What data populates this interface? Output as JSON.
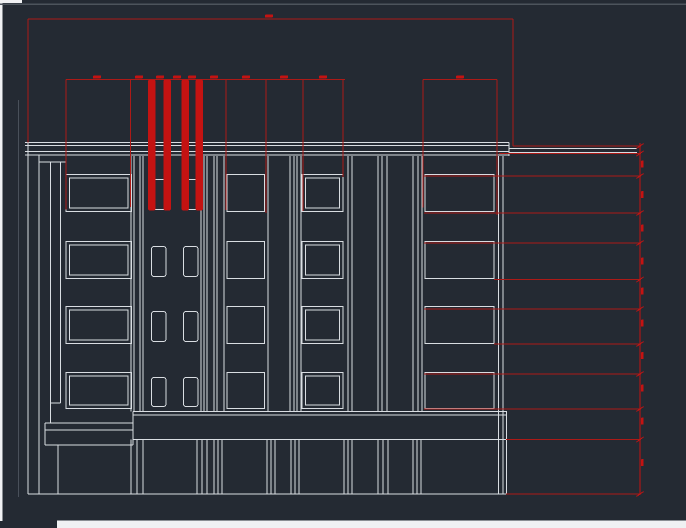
{
  "meta": {
    "description": "CAD viewport: building front elevation drawing with red dimension lines",
    "canvas_width": 686,
    "canvas_height": 528
  },
  "colors": {
    "background": "#242a33",
    "line_white": "#d9dde2",
    "line_bright": "#eef0f3",
    "line_gray": "#49505a",
    "dim_red": "#ac1a17",
    "dim_red_bright": "#c41312",
    "chrome_light": "#f0f1f3",
    "chrome_gray": "#4d545c"
  },
  "drawing": {
    "white_lines": [
      [
        25,
        142.5,
        509,
        142.5
      ],
      [
        25,
        145.5,
        509,
        145.5
      ],
      [
        25,
        151.5,
        509,
        151.5
      ],
      [
        25,
        155,
        509,
        155
      ],
      [
        509,
        148.5,
        637,
        148.5
      ],
      [
        509,
        152.5,
        637,
        152.5
      ],
      [
        509,
        142.5,
        509,
        156
      ],
      [
        28,
        142.5,
        28,
        494
      ],
      [
        39,
        155,
        39,
        494
      ],
      [
        50.5,
        162,
        50.5,
        423
      ],
      [
        60.5,
        162,
        60.5,
        403
      ],
      [
        39,
        162,
        66,
        162
      ],
      [
        50.5,
        403,
        60.5,
        403
      ],
      [
        58,
        445,
        58,
        494
      ],
      [
        498.5,
        156,
        498.5,
        494
      ],
      [
        503,
        156,
        503,
        494
      ],
      [
        506.5,
        411.5,
        506.5,
        494
      ],
      [
        133,
        411.5,
        507,
        411.5
      ],
      [
        133,
        415,
        507,
        415
      ],
      [
        133,
        439.5,
        507,
        439.5
      ],
      [
        45,
        423,
        133,
        423
      ],
      [
        45,
        430,
        133,
        430
      ],
      [
        45,
        445,
        133,
        445
      ],
      [
        45,
        423,
        45,
        445
      ],
      [
        133,
        411.5,
        133,
        445
      ],
      [
        28,
        494,
        507,
        494
      ]
    ],
    "pilasters": {
      "upper_x": [
        131,
        134,
        140,
        143,
        201,
        204,
        207,
        214,
        217,
        224,
        268,
        290,
        294,
        297,
        301,
        348,
        352,
        378,
        382,
        387,
        413,
        418,
        422
      ],
      "upper_y1": 156,
      "upper_y2": 411.5,
      "lower_x": [
        131,
        137,
        143,
        197,
        202,
        207,
        214,
        218,
        222,
        267,
        271,
        275,
        291,
        295,
        299,
        344,
        348,
        352,
        378,
        383,
        388,
        413,
        417,
        421
      ],
      "lower_y1": 439.5,
      "lower_y2": 494
    },
    "windows": {
      "rows": [
        [
          174.5,
          211.5
        ],
        [
          241.5,
          278.5
        ],
        [
          306.5,
          343.5
        ],
        [
          372.5,
          408.5
        ]
      ],
      "columns": [
        {
          "name": "bay-1",
          "style": "double",
          "x": 66,
          "w": 65.5,
          "inset": 3.5
        },
        {
          "name": "small-a",
          "style": "small",
          "x": 151.5,
          "w": 14.5
        },
        {
          "name": "small-b",
          "style": "small",
          "x": 183.5,
          "w": 14.5
        },
        {
          "name": "bay-2",
          "style": "single",
          "x": 227,
          "w": 37.5
        },
        {
          "name": "bay-3",
          "style": "double",
          "x": 302,
          "w": 41,
          "inset": 3.5
        },
        {
          "name": "bay-4",
          "style": "single",
          "x": 425,
          "w": 69
        }
      ]
    },
    "dimensions": {
      "red_lines": [
        [
          28,
          19,
          513,
          19
        ],
        [
          28,
          19,
          28,
          142.5
        ],
        [
          513,
          19,
          513,
          146
        ],
        [
          66,
          79.5,
          345,
          79.5
        ],
        [
          423,
          79.5,
          497,
          79.5
        ],
        [
          66,
          79.5,
          66,
          209.5
        ],
        [
          130.5,
          79.5,
          130.5,
          207
        ],
        [
          226,
          79.5,
          226,
          210
        ],
        [
          266,
          79.5,
          266,
          213
        ],
        [
          303,
          79.5,
          303,
          211
        ],
        [
          343,
          79.5,
          343,
          177
        ],
        [
          423,
          79.5,
          423,
          207.5
        ],
        [
          497,
          79.5,
          497,
          215
        ],
        [
          513,
          146,
          641,
          146
        ],
        [
          499,
          153.5,
          641,
          153.5
        ],
        [
          424,
          176,
          641,
          176
        ],
        [
          424,
          213,
          641,
          213
        ],
        [
          424,
          243,
          641,
          243
        ],
        [
          494,
          279.5,
          641,
          279.5
        ],
        [
          424,
          309,
          641,
          309
        ],
        [
          494,
          344,
          641,
          344
        ],
        [
          424,
          374,
          641,
          374
        ],
        [
          424,
          409,
          641,
          409
        ],
        [
          506,
          439.5,
          641,
          439.5
        ],
        [
          506,
          494,
          641,
          494
        ]
      ],
      "chain_line": [
        640,
        143,
        640,
        494
      ],
      "chain_tick_ys": [
        146,
        153.5,
        176,
        213,
        243,
        279.5,
        309,
        344,
        374,
        409,
        439.5,
        494
      ],
      "extension_bars": {
        "x_list": [
          148,
          163.5,
          181.5,
          195.5
        ],
        "y1": 79.5,
        "y2": 210.5,
        "w": 7.5
      },
      "text_blips_h": [
        {
          "x": 269,
          "y": 16
        },
        {
          "x": 97,
          "y": 77
        },
        {
          "x": 139,
          "y": 77
        },
        {
          "x": 160,
          "y": 77
        },
        {
          "x": 177,
          "y": 77
        },
        {
          "x": 192,
          "y": 77
        },
        {
          "x": 214,
          "y": 77
        },
        {
          "x": 246,
          "y": 77
        },
        {
          "x": 284,
          "y": 77
        },
        {
          "x": 323,
          "y": 77
        },
        {
          "x": 460,
          "y": 77
        }
      ],
      "text_blips_v": [
        {
          "x": 642.3,
          "y": 164
        },
        {
          "x": 642.3,
          "y": 194.5
        },
        {
          "x": 642.3,
          "y": 228
        },
        {
          "x": 642.3,
          "y": 261
        },
        {
          "x": 642.3,
          "y": 291
        },
        {
          "x": 642.3,
          "y": 323
        },
        {
          "x": 642.3,
          "y": 355.5
        },
        {
          "x": 642.3,
          "y": 388
        },
        {
          "x": 642.3,
          "y": 421
        },
        {
          "x": 642.3,
          "y": 462.5
        }
      ]
    },
    "chrome": {
      "left_strip": [
        0,
        0,
        2.5,
        521
      ],
      "top_left_corner": [
        0,
        0,
        22,
        3
      ],
      "top_border": [
        0,
        3.6,
        686,
        1.2
      ],
      "bottom_strip": [
        57,
        520.5,
        629,
        7.5
      ],
      "faint_vertical": [
        18,
        100,
        0.9,
        397
      ]
    }
  }
}
